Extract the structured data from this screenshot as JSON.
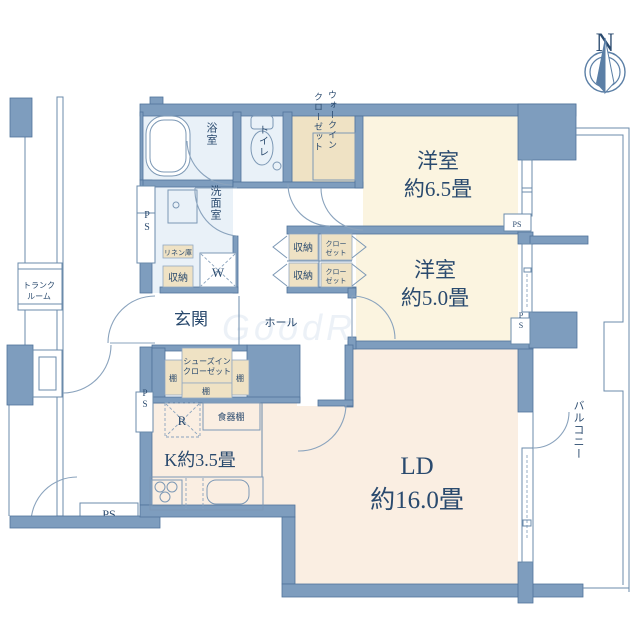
{
  "compass": {
    "north": "N"
  },
  "watermark": "GoodRoom",
  "colors": {
    "wall": "#7e9dbe",
    "bedroom_floor": "#fbf4e0",
    "living_floor": "#faeee2",
    "wet_floor": "#e9f1f8",
    "closet_fill": "#efe2c4",
    "text": "#2a4a6e"
  },
  "common_area": {
    "trunk_room_line1": "トランク",
    "trunk_room_line2": "ルーム",
    "ps_label": "PS"
  },
  "wet_area": {
    "bath": "浴室",
    "toilet": "トイレ",
    "washroom": "洗面室",
    "linen": "リネン庫",
    "storage": "収納",
    "washer": "W"
  },
  "walk_in_closet": {
    "line1": "ウォークイン",
    "line2": "クローゼット"
  },
  "bedroom1": {
    "name": "洋室",
    "size": "約6.5畳"
  },
  "bedroom2": {
    "name": "洋室",
    "size": "約5.0畳"
  },
  "hall": {
    "hall_label": "ホール",
    "entrance_label": "玄関",
    "storage_label": "収納",
    "closet_line1": "クロー",
    "closet_line2": "ゼット"
  },
  "shoes_closet": {
    "line1": "シューズイン",
    "line2": "クローゼット",
    "shelf": "棚"
  },
  "kitchen": {
    "label": "K約3.5畳",
    "fridge": "R",
    "cupboard": "食器棚"
  },
  "living": {
    "name": "LD",
    "size": "約16.0畳"
  },
  "balcony": {
    "label": "バルコニー"
  },
  "ps_label": "PS"
}
